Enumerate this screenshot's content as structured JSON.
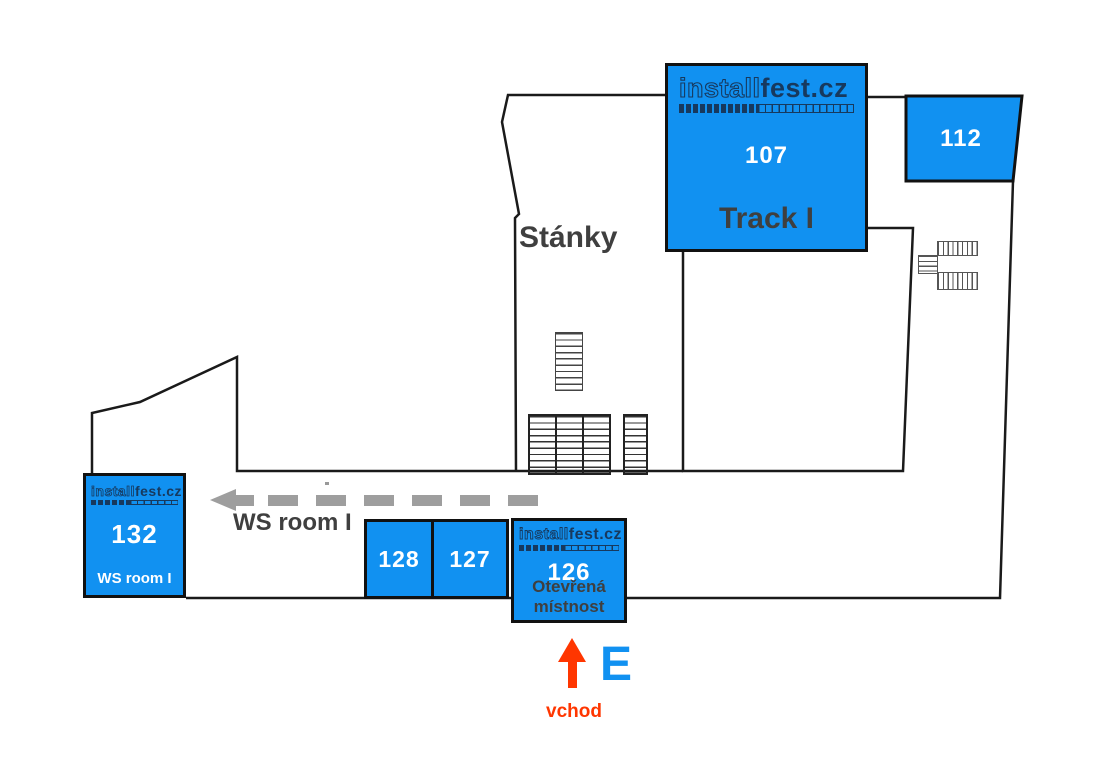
{
  "map_title_logo": {
    "part1": "install",
    "part2": "fest.cz"
  },
  "logo": {
    "part1": "install",
    "part2": "fest.cz"
  },
  "rooms": {
    "track1": {
      "number": "107",
      "name": "Track I"
    },
    "r112": {
      "number": "112"
    },
    "r132": {
      "number": "132",
      "name": "WS room I"
    },
    "r128": {
      "number": "128"
    },
    "r127": {
      "number": "127"
    },
    "r126": {
      "number": "126",
      "name_line1": "Otevřená",
      "name_line2": "místnost"
    }
  },
  "labels": {
    "stands": "Stánky",
    "ws_room_arrow": "WS room I",
    "entrance_letter": "E",
    "entrance_label": "vchod"
  },
  "icons": {
    "ws_arrow": "dashed-arrow-left-icon",
    "entrance_arrow": "arrow-up-icon",
    "straight_stairs": "stairs-icon",
    "u_turn_stairs": "u-stairs-icon",
    "stand_tables": "tables-icon"
  },
  "colors": {
    "room_blue": "#1191F1",
    "logo_navy": "#17395E",
    "wall_black": "#1a1a1a",
    "label_dark_gray": "#3F3F3F",
    "arrow_gray": "#9E9E9E",
    "entrance_red": "#FF3600",
    "entrance_blue": "#1191F1"
  }
}
